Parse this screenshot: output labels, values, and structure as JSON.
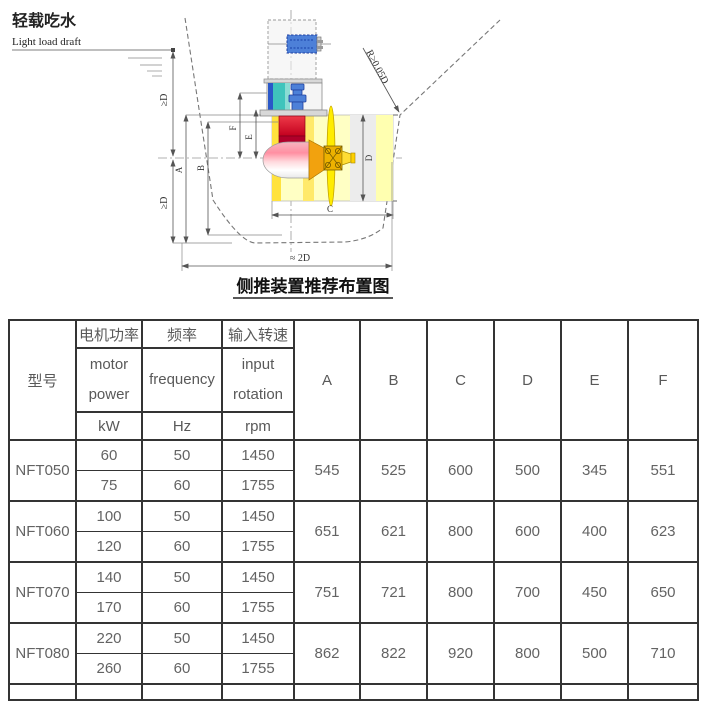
{
  "diagram": {
    "title": "侧推装置推荐布置图",
    "draft_label_zh": "轻载吃水",
    "draft_label_en": "Light load draft",
    "dim_ge_d": "≥D",
    "radius_note": "R≥0.05D",
    "span_note": "≈ 2D",
    "dim_letters": [
      "A",
      "B",
      "C",
      "D",
      "E",
      "F"
    ],
    "colors": {
      "motor_blue": "#4d80d8",
      "coupling_teal": "#3fc4bc",
      "gearbox_red": "#d01030",
      "pod_pink": "#ff8fa2",
      "cone_orange": "#f2a20e",
      "propeller_yellow": "#ffec00",
      "tunnel_yellow": "#ffffc4"
    }
  },
  "table": {
    "header": {
      "model": "型号",
      "cols": [
        {
          "zh": "电机功率",
          "en": [
            "motor",
            "power"
          ],
          "unit": "kW"
        },
        {
          "zh": "频率",
          "en": [
            "frequency"
          ],
          "unit": "Hz"
        },
        {
          "zh": "输入转速",
          "en": [
            "input",
            "rotation"
          ],
          "unit": "rpm"
        }
      ],
      "dims": [
        "A",
        "B",
        "C",
        "D",
        "E",
        "F"
      ]
    },
    "rows": [
      {
        "model": "NFT050",
        "power": [
          60,
          75
        ],
        "freq": [
          50,
          60
        ],
        "rpm": [
          1450,
          1755
        ],
        "dims": [
          545,
          525,
          600,
          500,
          345,
          551
        ]
      },
      {
        "model": "NFT060",
        "power": [
          100,
          120
        ],
        "freq": [
          50,
          60
        ],
        "rpm": [
          1450,
          1755
        ],
        "dims": [
          651,
          621,
          800,
          600,
          400,
          623
        ]
      },
      {
        "model": "NFT070",
        "power": [
          140,
          170
        ],
        "freq": [
          50,
          60
        ],
        "rpm": [
          1450,
          1755
        ],
        "dims": [
          751,
          721,
          800,
          700,
          450,
          650
        ]
      },
      {
        "model": "NFT080",
        "power": [
          220,
          260
        ],
        "freq": [
          50,
          60
        ],
        "rpm": [
          1450,
          1755
        ],
        "dims": [
          862,
          822,
          920,
          800,
          500,
          710
        ]
      }
    ]
  }
}
